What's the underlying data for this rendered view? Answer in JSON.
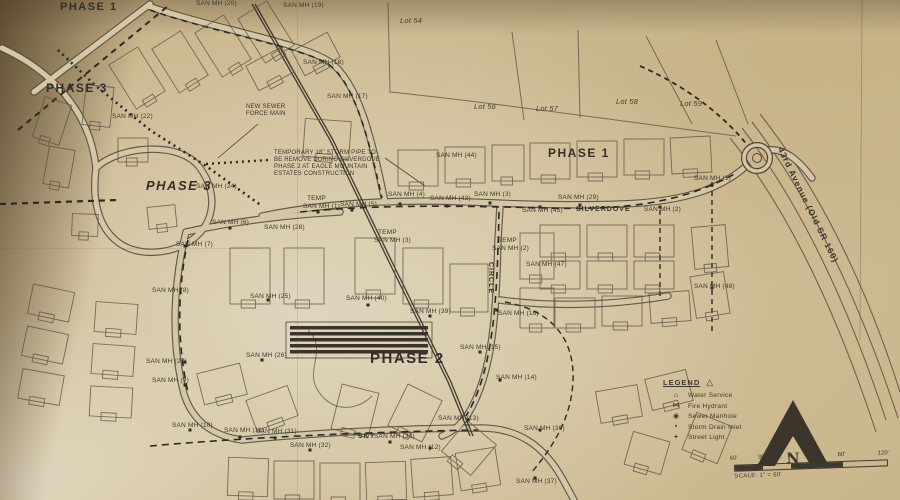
{
  "photo": {
    "paper": "#c9b488",
    "ink": "#4f4637",
    "dark_ink": "#2e2a22"
  },
  "map": {
    "phase_labels": [
      {
        "text": "PHASE 1",
        "x": 60,
        "y": 2,
        "size": 11
      },
      {
        "text": "PHASE 3",
        "x": 46,
        "y": 82,
        "size": 12
      },
      {
        "text": "PHASE 3",
        "x": 146,
        "y": 179,
        "size": 13,
        "italic": true
      },
      {
        "text": "PHASE 1",
        "x": 548,
        "y": 147,
        "size": 12
      },
      {
        "text": "PHASE 2",
        "x": 370,
        "y": 351,
        "size": 15
      }
    ],
    "lot_labels": [
      {
        "text": "Lot 54",
        "x": 400,
        "y": 17
      },
      {
        "text": "Lot 56",
        "x": 474,
        "y": 103
      },
      {
        "text": "Lot 57",
        "x": 536,
        "y": 105
      },
      {
        "text": "Lot 58",
        "x": 616,
        "y": 98
      },
      {
        "text": "Lot 59",
        "x": 680,
        "y": 100
      }
    ],
    "street_labels": [
      {
        "text": "SILVERDOVE",
        "x": 576,
        "y": 206
      },
      {
        "text": "CIRCLE",
        "x": 494,
        "y": 262,
        "r": 90
      },
      {
        "text": "SKY",
        "x": 358,
        "y": 433
      },
      {
        "text": "43rd Avenue (Old SR 160)",
        "x": 784,
        "y": 146,
        "r": 64,
        "size": 8.5
      }
    ],
    "manhole_labels": [
      {
        "text": "SAN MH (20)",
        "x": 196,
        "y": 1
      },
      {
        "text": "SAN MH (19)",
        "x": 283,
        "y": 3
      },
      {
        "text": "SAN MH (18)",
        "x": 303,
        "y": 60
      },
      {
        "text": "SAN MH (17)",
        "x": 327,
        "y": 94
      },
      {
        "text": "SAN MH (22)",
        "x": 112,
        "y": 114
      },
      {
        "text": "SAN MH (24)",
        "x": 196,
        "y": 184
      },
      {
        "text": "SAN MH (7)",
        "x": 176,
        "y": 242
      },
      {
        "text": "SAN MH (6)",
        "x": 212,
        "y": 220
      },
      {
        "text": "SAN MH (28)",
        "x": 264,
        "y": 225
      },
      {
        "text": "TEMP",
        "x": 307,
        "y": 196
      },
      {
        "text": "SAN MH (1)",
        "x": 303,
        "y": 204
      },
      {
        "text": "SAN MH (5)",
        "x": 340,
        "y": 202
      },
      {
        "text": "SAN MH (4)",
        "x": 388,
        "y": 192
      },
      {
        "text": "SAN MH (43)",
        "x": 430,
        "y": 196
      },
      {
        "text": "SAN MH (3)",
        "x": 474,
        "y": 192
      },
      {
        "text": "SAN MH (44)",
        "x": 436,
        "y": 153
      },
      {
        "text": "SAN MH (45)",
        "x": 522,
        "y": 208
      },
      {
        "text": "SAN MH (29)",
        "x": 558,
        "y": 195
      },
      {
        "text": "SAN MH (2)",
        "x": 644,
        "y": 207
      },
      {
        "text": "SAN MH (1)",
        "x": 694,
        "y": 176
      },
      {
        "text": "TEMP",
        "x": 498,
        "y": 238
      },
      {
        "text": "SAN MH (2)",
        "x": 492,
        "y": 246
      },
      {
        "text": "SAN MH (47)",
        "x": 526,
        "y": 262
      },
      {
        "text": "SAN MH (48)",
        "x": 694,
        "y": 284
      },
      {
        "text": "TEMP",
        "x": 378,
        "y": 230
      },
      {
        "text": "SAN MH (3)",
        "x": 374,
        "y": 238
      },
      {
        "text": "SAN MH (40)",
        "x": 346,
        "y": 296
      },
      {
        "text": "SAN MH (39)",
        "x": 410,
        "y": 309
      },
      {
        "text": "SAN MH (16)",
        "x": 498,
        "y": 311
      },
      {
        "text": "SAN MH (15)",
        "x": 460,
        "y": 345
      },
      {
        "text": "SAN MH (14)",
        "x": 496,
        "y": 375
      },
      {
        "text": "SAN MH (13)",
        "x": 438,
        "y": 416
      },
      {
        "text": "SAN MH (12)",
        "x": 400,
        "y": 445
      },
      {
        "text": "SAN MH (33)",
        "x": 374,
        "y": 434
      },
      {
        "text": "SAN MH (32)",
        "x": 290,
        "y": 443
      },
      {
        "text": "SAN MH (31)",
        "x": 256,
        "y": 429
      },
      {
        "text": "SAN MH (11)",
        "x": 224,
        "y": 428
      },
      {
        "text": "SAN MH (10)",
        "x": 172,
        "y": 423
      },
      {
        "text": "SAN MH (9)",
        "x": 152,
        "y": 378
      },
      {
        "text": "SAN MH (27)",
        "x": 146,
        "y": 359
      },
      {
        "text": "SAN MH (26)",
        "x": 246,
        "y": 353
      },
      {
        "text": "SAN MH (25)",
        "x": 250,
        "y": 294
      },
      {
        "text": "SAN MH (8)",
        "x": 152,
        "y": 288
      },
      {
        "text": "SAN MH (36)",
        "x": 524,
        "y": 426
      },
      {
        "text": "SAN MH (37)",
        "x": 516,
        "y": 479
      }
    ],
    "notes": [
      {
        "lines": [
          "NEW SEWER",
          "FORCE MAIN"
        ],
        "x": 246,
        "y": 104
      },
      {
        "lines": [
          "TEMPORARY 18\" STORM PIPE TO",
          "BE REMOVE DURING SILVERDOVE",
          "PHASE 2 AT EAGLE MOUNTAIN",
          "ESTATES CONSTRUCTION"
        ],
        "x": 274,
        "y": 150
      }
    ],
    "legend": {
      "title": "LEGEND",
      "items": [
        {
          "icon": "water-service",
          "label": "Water Service"
        },
        {
          "icon": "fire-hydrant",
          "label": "Fire Hydrant"
        },
        {
          "icon": "sewer-manhole",
          "label": "Sewer Manhole"
        },
        {
          "icon": "storm-drain-inlet",
          "label": "Storm Drain Inlet"
        },
        {
          "icon": "street-light",
          "label": "Street Light"
        }
      ]
    },
    "north_arrow": {
      "letter": "N"
    },
    "scale_bar": {
      "ticks": [
        "60'",
        "30'",
        "0'",
        "60'",
        "120'"
      ],
      "caption": "SCALE: 1\" = 60'"
    }
  }
}
